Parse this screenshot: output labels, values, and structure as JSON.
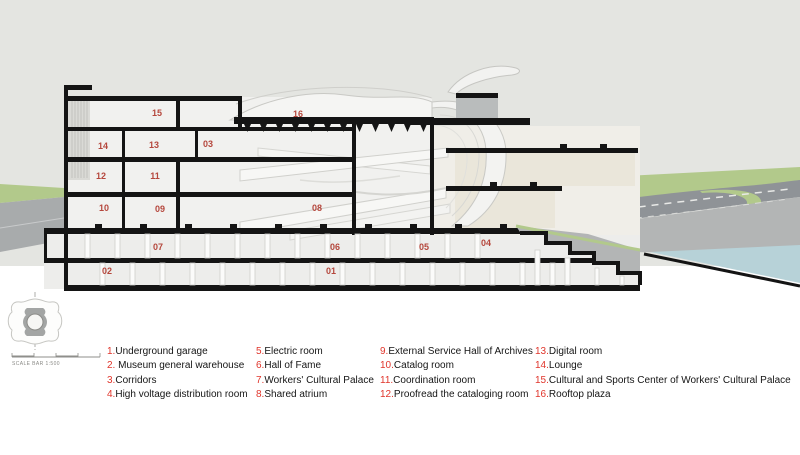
{
  "section": {
    "labels": [
      "01",
      "02",
      "03",
      "04",
      "05",
      "06",
      "07",
      "08",
      "09",
      "10",
      "11",
      "12",
      "13",
      "14",
      "15",
      "16"
    ]
  },
  "site_key": {
    "scale_text": "SCALE BAR 1:500"
  },
  "legend": {
    "items": [
      {
        "num": "1.",
        "label": "Underground garage"
      },
      {
        "num": "2.",
        "label": " Museum general warehouse"
      },
      {
        "num": "3.",
        "label": "Corridors"
      },
      {
        "num": "4.",
        "label": "High voltage distribution room"
      },
      {
        "num": "5.",
        "label": "Electric room"
      },
      {
        "num": "6.",
        "label": "Hall of Fame"
      },
      {
        "num": "7.",
        "label": "Workers' Cultural Palace"
      },
      {
        "num": "8.",
        "label": "Shared atrium"
      },
      {
        "num": "9.",
        "label": "External Service Hall of Archives"
      },
      {
        "num": "10.",
        "label": "Catalog room"
      },
      {
        "num": "11.",
        "label": "Coordination room"
      },
      {
        "num": "12.",
        "label": "Proofread the cataloging room"
      },
      {
        "num": "13.",
        "label": "Digital room"
      },
      {
        "num": "14.",
        "label": "Lounge"
      },
      {
        "num": "15.",
        "label": "Cultural and Sports Center of Workers' Cultural Palace"
      },
      {
        "num": "16.",
        "label": "Rooftop plaza"
      }
    ]
  },
  "colors": {
    "sky": "#e4e5e1",
    "grass": "#b2c98b",
    "road_dark": "#8f9397",
    "road_light": "#b3b5b5",
    "water": "#b7d2d8",
    "poche_black": "#141414",
    "label_red": "#b0392e",
    "legend_red": "#e0352b"
  }
}
